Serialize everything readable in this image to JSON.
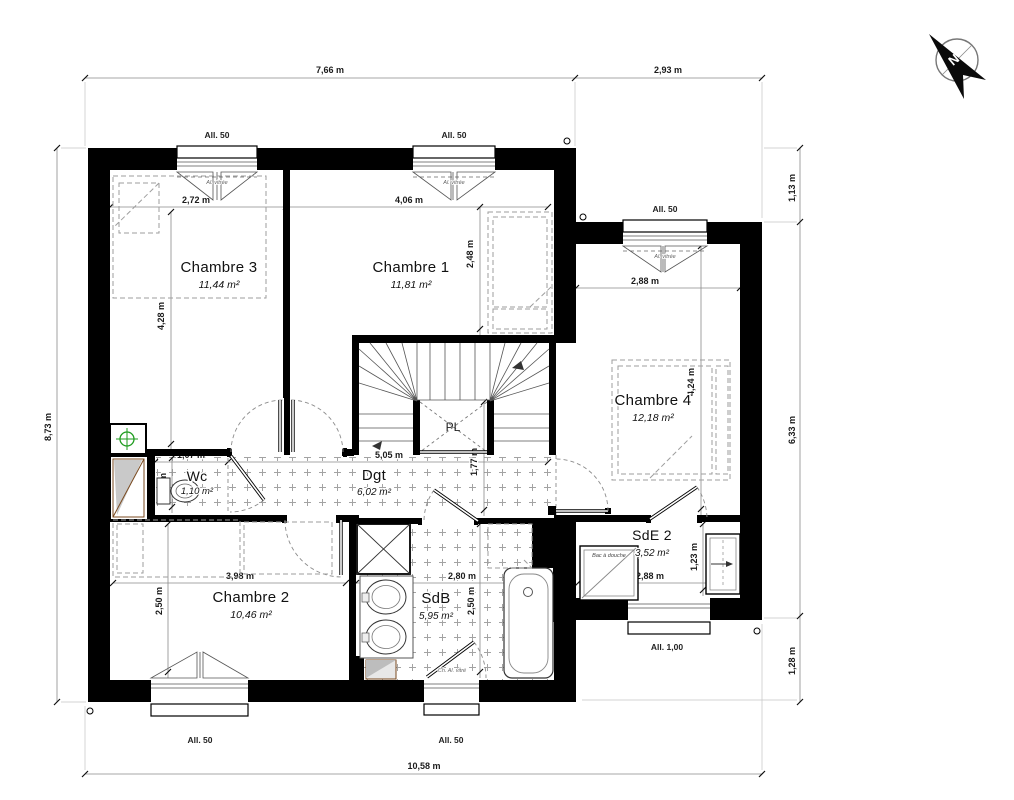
{
  "plan_title": "Etage - plan",
  "rooms": {
    "ch3": {
      "name": "Chambre 3",
      "area": "11,44 m²"
    },
    "ch1": {
      "name": "Chambre 1",
      "area": "11,81 m²"
    },
    "ch4": {
      "name": "Chambre 4",
      "area": "12,18 m²"
    },
    "ch2": {
      "name": "Chambre 2",
      "area": "10,46 m²"
    },
    "wc": {
      "name": "Wc",
      "area": "1,10 m²"
    },
    "dgt": {
      "name": "Dgt",
      "area": "6,02 m²"
    },
    "sdb": {
      "name": "SdB",
      "area": "5,95 m²"
    },
    "sde2": {
      "name": "SdE 2",
      "area": "3,52 m²"
    }
  },
  "dims": {
    "top_left": "7,66 m",
    "top_right": "2,93 m",
    "bottom": "10,58 m",
    "left": "8,73 m",
    "right_top": "1,13 m",
    "right_mid": "6,33 m",
    "right_bot": "1,28 m",
    "ch3_w": "2,72 m",
    "ch3_h": "4,28 m",
    "ch1_w": "4,06 m",
    "ch1_h": "2,48 m",
    "ch4_w": "2,88 m",
    "ch4_h": "4,24 m",
    "ch2_w": "3,98 m",
    "ch2_h": "2,50 m",
    "sdb_w": "2,80 m",
    "sdb_h": "2,50 m",
    "sde2_w": "2,88 m",
    "sde2_h": "1,23 m",
    "wc_w": "1,07 m",
    "wc_h": "1,03 m",
    "hall_w": "5,05 m",
    "hall_h": "1,77 m"
  },
  "sills": {
    "s50": "All. 50",
    "s100": "All. 1,00"
  },
  "labels": {
    "closet": "PL",
    "shower_tray": "Bac à douche",
    "compass_north": "N",
    "window_note": "Al. vitrée",
    "sdb_window_note": "Ch. Al. vitré"
  },
  "colors": {
    "wall": "#000000",
    "symbol_green": "#1d9b1d",
    "duct_brown": "#7a4a1f"
  }
}
